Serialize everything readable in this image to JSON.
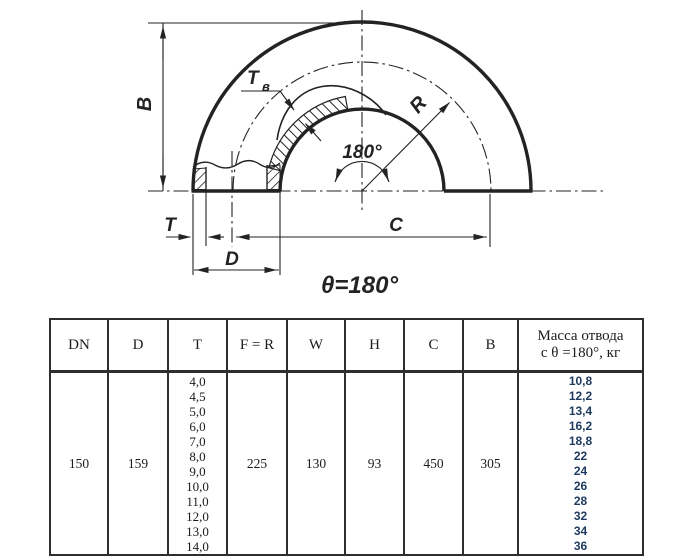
{
  "diagram": {
    "labels": {
      "b": "B",
      "t": "T",
      "d": "D",
      "c": "C",
      "r": "R",
      "tv_main": "T",
      "tv_sub": "в",
      "angle": "180°",
      "theta": "θ=180°"
    },
    "colors": {
      "line": "#232323"
    }
  },
  "table": {
    "headers": [
      "DN",
      "D",
      "T",
      "F = R",
      "W",
      "H",
      "C",
      "B"
    ],
    "mass_header": {
      "line1": "Масса отвода",
      "line2": "с θ =180°, кг"
    },
    "row": {
      "dn": "150",
      "d": "159",
      "f_r": "225",
      "w": "130",
      "h": "93",
      "c": "450",
      "b": "305"
    },
    "t_values": [
      "4,0",
      "4,5",
      "5,0",
      "6,0",
      "7,0",
      "8,0",
      "9,0",
      "10,0",
      "11,0",
      "12,0",
      "13,0",
      "14,0"
    ],
    "mass_values": [
      "10,8",
      "12,2",
      "13,4",
      "16,2",
      "18,8",
      "22",
      "24",
      "26",
      "28",
      "32",
      "34",
      "36"
    ],
    "mass_color": "#1e3a5f",
    "border_color": "#2e2e2e"
  }
}
